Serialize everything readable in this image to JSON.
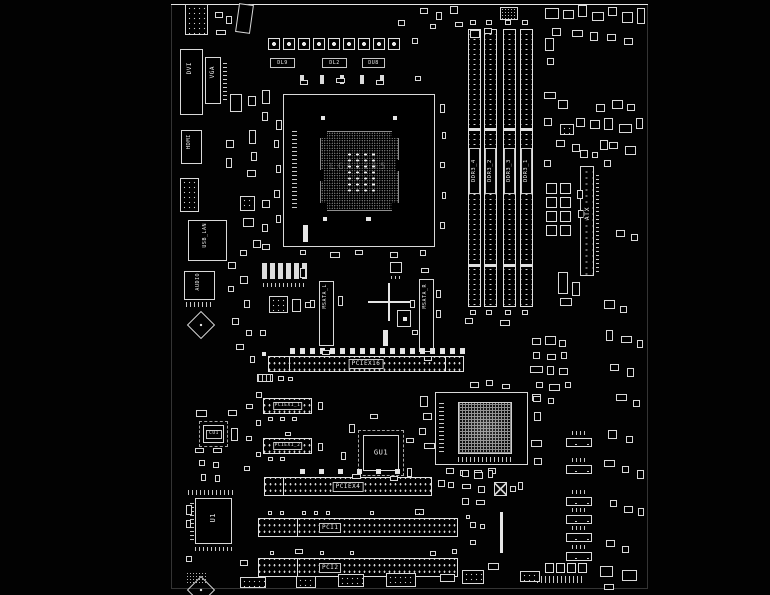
{
  "app": {
    "background_color": "#000000",
    "trace_color": "#e8e8e8"
  },
  "rear_io": {
    "dvi_label": "DVI",
    "vga_label": "VGA",
    "hdmi_label": "HDMI",
    "usb_lan_label": "USB_LAN",
    "audio_label": "AUDIO"
  },
  "cpu": {
    "socket_label": "LGA1155"
  },
  "memory": {
    "slot_labels": [
      "DDR3_4",
      "DDR3_2",
      "DDR3_3",
      "DDR3_1"
    ]
  },
  "power": {
    "atx_label": "ATX"
  },
  "storage": {
    "msata_left_label": "MSATA_L",
    "msata_right_label": "MSATA_R"
  },
  "expansion": {
    "pciex16_label": "PCIEX16",
    "pciex1_1_label": "PCIEX1_1",
    "pciex1_2_label": "PCIEX1_2",
    "pciex4_label": "PCIEX4",
    "pci1_label": "PCI1",
    "pci2_label": "PCI2"
  },
  "chips": {
    "gu1_label": "GU1",
    "cu1_label": "CU1",
    "u1_label": "U1"
  },
  "designators": [
    "DL9",
    "DL2",
    "DU8"
  ]
}
